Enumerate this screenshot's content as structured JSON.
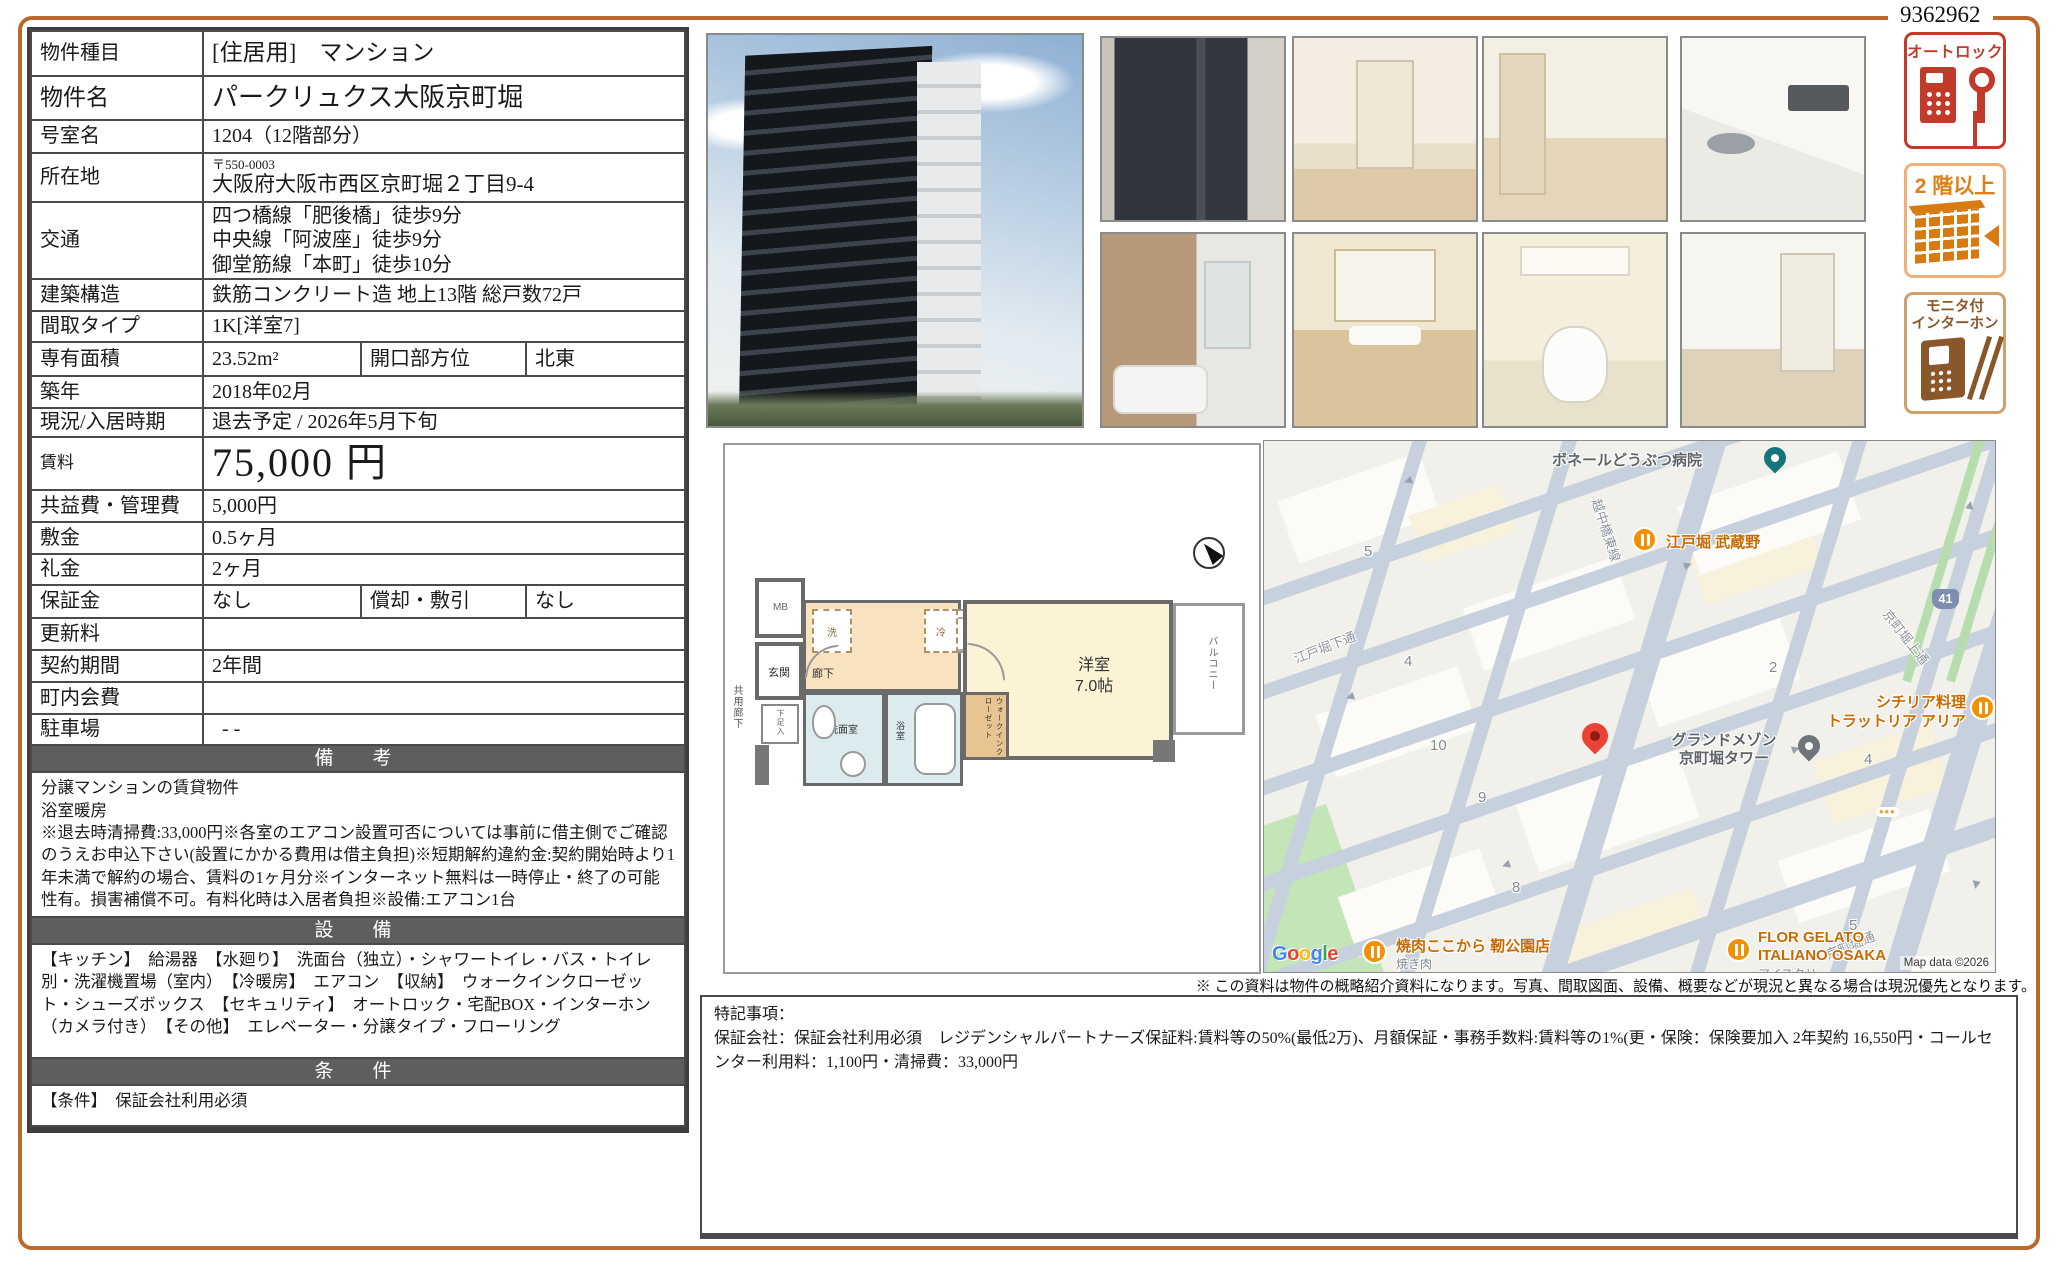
{
  "page": {
    "doc_number": "9362962",
    "disclaimer": "※ この資料は物件の概略紹介資料になります。写真、間取図面、設備、概要などが現況と異なる場合は現況優先となります。"
  },
  "table": {
    "rows": [
      {
        "label": "物件種目",
        "value": "[住居用]　マンション"
      },
      {
        "label": "物件名",
        "value": "パークリュクス大阪京町堀"
      },
      {
        "label": "号室名",
        "value": "1204（12階部分）"
      },
      {
        "label": "所在地",
        "postal": "〒550-0003",
        "value": "大阪府大阪市西区京町堀２丁目9-4"
      },
      {
        "label": "交通",
        "value": "四つ橋線「肥後橋」徒歩9分\n中央線「阿波座」徒歩9分\n御堂筋線「本町」徒歩10分"
      },
      {
        "label": "建築構造",
        "value": "鉄筋コンクリート造 地上13階 総戸数72戸"
      },
      {
        "label": "間取タイプ",
        "value": "1K[洋室7]"
      },
      {
        "label": "専有面積",
        "value": "23.52m²",
        "label2": "開口部方位",
        "value2": "北東"
      },
      {
        "label": "築年",
        "value": "2018年02月"
      },
      {
        "label": "現況/入居時期",
        "value": "退去予定 / 2026年5月下旬"
      },
      {
        "label": "賃料",
        "value": "75,000 円"
      },
      {
        "label": "共益費・管理費",
        "value": "5,000円"
      },
      {
        "label": "敷金",
        "value": "0.5ヶ月"
      },
      {
        "label": "礼金",
        "value": "2ヶ月"
      },
      {
        "label": "保証金",
        "value": "なし",
        "label2": "償却・敷引",
        "value2": "なし"
      },
      {
        "label": "更新料",
        "value": ""
      },
      {
        "label": "契約期間",
        "value": "2年間"
      },
      {
        "label": "町内会費",
        "value": ""
      },
      {
        "label": "駐車場",
        "value": "- -"
      }
    ],
    "remarks_title": "備　考",
    "remarks_body": "分譲マンションの賃貸物件\n浴室暖房\n※退去時清掃費:33,000円※各室のエアコン設置可否については事前に借主側でご確認のうえお申込下さい(設置にかかる費用は借主負担)※短期解約違約金:契約開始時より1年未満で解約の場合、賃料の1ヶ月分※インターネット無料は一時停止・終了の可能性有。損害補償不可。有料化時は入居者負担※設備:エアコン1台",
    "equipment_title": "設　備",
    "equipment_body": "【キッチン】　給湯器　【水廻り】　洗面台（独立）・シャワートイレ・バス・トイレ別・洗濯機置場（室内）　【冷暖房】　エアコン　【収納】　ウォークインクローゼット・シューズボックス　【セキュリティ】　オートロック・宅配BOX・インターホン（カメラ付き）　【その他】　エレベーター・分譲タイプ・フローリング",
    "conditions_title": "条　件",
    "conditions_body": "【条件】　保証会社利用必須"
  },
  "badges": {
    "autolock": "オートロック",
    "upper_floor": "2 階以上",
    "intercom": "モニタ付\nインターホン"
  },
  "floor_plan": {
    "mb": "MB",
    "entrance": "玄関",
    "common_corridor": "共用廊下",
    "shoe_box": "下足入",
    "hallway": "廊下",
    "washer": "洗",
    "fridge": "冷",
    "washroom": "洗面室",
    "bathroom": "浴室",
    "wic": "ウォークインクローゼット",
    "room": "洋室\n7.0帖",
    "balcony": "バルコニー"
  },
  "map": {
    "streets": {
      "ecchubashi": "越中橋東線",
      "edobori_shimo": "江戸堀下通",
      "kyomachibori_kami": "京町堀上通",
      "kyomachibori": "京町堀通"
    },
    "pois": {
      "hospital": "ボネールどうぶつ病院",
      "musashino": "江戸堀 武蔵野",
      "trattoria1": "シチリア料理",
      "trattoria2": "トラットリア アリア",
      "grand1": "グランドメゾン",
      "grand2": "京町堀タワー",
      "yakiniku": "焼肉ここから 靭公園店",
      "yakiniku_sub": "焼き肉",
      "gelato1": "FLOR GELATO",
      "gelato2": "ITALIANO OSAKA",
      "gelato_sub": "アイスクリ"
    },
    "route_shield": "41",
    "blocks": {
      "b5a": "5",
      "b4a": "4",
      "b10": "10",
      "b2": "2",
      "b9": "9",
      "b8": "8",
      "b4b": "4",
      "b5b": "5"
    },
    "google": [
      "G",
      "o",
      "o",
      "g",
      "l",
      "e"
    ],
    "attribution": "Map data ©2026"
  },
  "notes": {
    "body": "特記事項：\n保証会社：保証会社利用必須　レジデンシャルパートナーズ保証料:賃料等の50%(最低2万)、月額保証・事務手数料:賃料等の1%(更・保険：保険要加入 2年契約 16,550円・コールセンター利用料：1,100円・清掃費：33,000円"
  }
}
